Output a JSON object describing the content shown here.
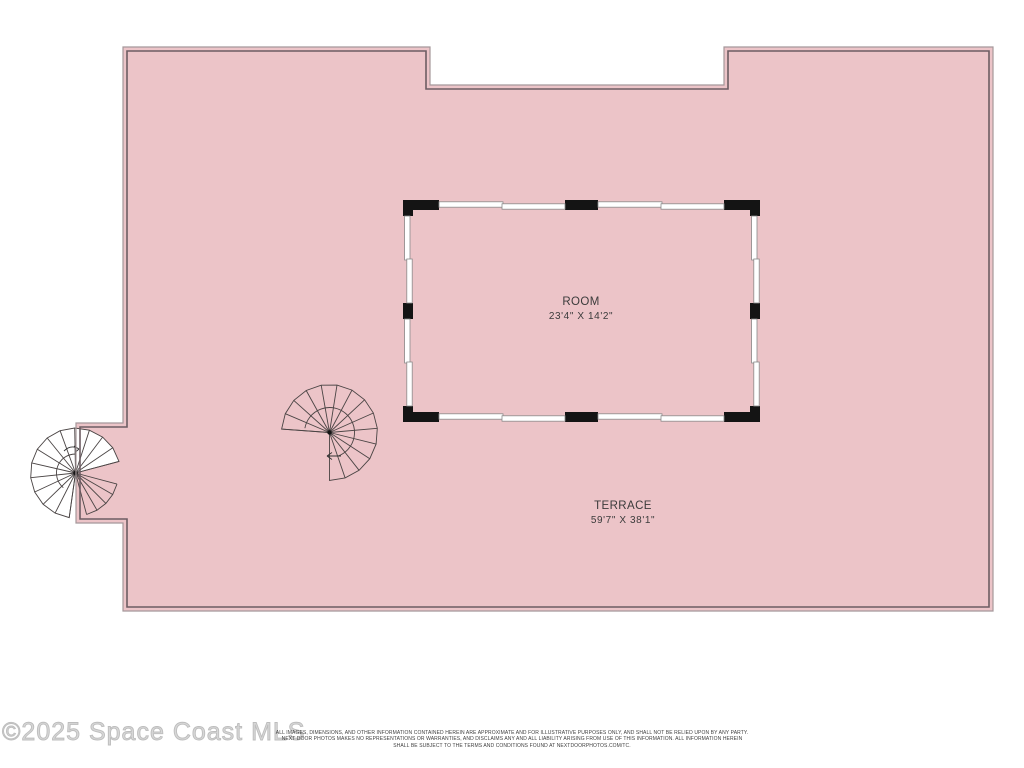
{
  "floor_plan": {
    "room": {
      "name": "ROOM",
      "dimensions": "23'4\" X 14'2\""
    },
    "terrace": {
      "name": "TERRACE",
      "dimensions": "59'7\" X 38'1\""
    },
    "features": [
      "spiral-stair-left",
      "spiral-stair-center"
    ],
    "colors": {
      "terrace_fill": "#ecc4c8",
      "outline_light": "#a5989a",
      "outline_dark": "#6d5d63",
      "wall_black": "#141414",
      "window_stroke": "#8b8b8b",
      "label_text": "#3b3b3b"
    }
  },
  "watermark": {
    "text": "©2025 Space Coast MLS"
  },
  "disclaimer": {
    "lines": [
      "ALL IMAGES, DIMENSIONS, AND OTHER INFORMATION CONTAINED HEREIN ARE APPROXIMATE AND FOR ILLUSTRATIVE PURPOSES ONLY, AND SHALL NOT BE RELIED UPON BY ANY PARTY.",
      "NEXT DOOR PHOTOS MAKES NO REPRESENTATIONS OR WARRANTIES, AND DISCLAIMS ANY AND ALL LIABILITY ARISING FROM USE OF THIS INFORMATION. ALL INFORMATION HEREIN",
      "SHALL BE SUBJECT TO THE TERMS AND CONDITIONS FOUND AT NEXTDOORPHOTOS.COM/TC."
    ]
  }
}
